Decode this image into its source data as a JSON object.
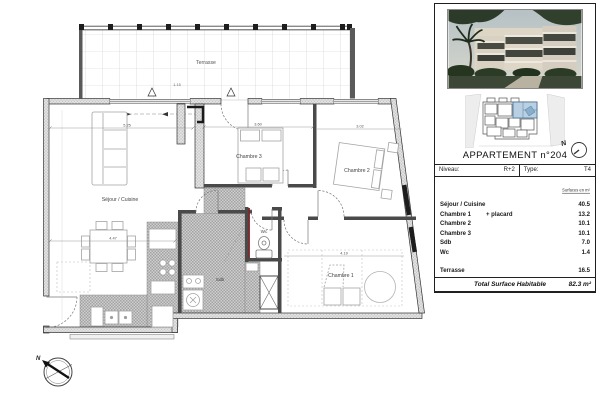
{
  "plan": {
    "rooms": {
      "terrasse": "Terrasse",
      "sejour": "Séjour / Cuisine",
      "chambre3": "Chambre 3",
      "chambre2": "Chambre 2",
      "chambre1": "Chambre 1",
      "sdb": "Sdb",
      "wc": "Wc"
    },
    "dimensions": {
      "sejour_width": "5.25",
      "chambre3_width": "3.60",
      "chambre2_width": "3.02",
      "sejour_depth": "4.47",
      "chambre1_width": "4.19",
      "terrasse_depth": "1.15"
    },
    "north_label": "N"
  },
  "panel": {
    "title": "APPARTEMENT n°204",
    "info": {
      "niveau_label": "Niveau:",
      "niveau_value": "R+2",
      "type_label": "Type:",
      "type_value": "T4"
    },
    "surfaces_note": "Surfaces en m²",
    "rooms": [
      {
        "name": "Séjour / Cuisine",
        "note": "",
        "area": "40.5"
      },
      {
        "name": "Chambre 1",
        "note": "+ placard",
        "area": "13.2"
      },
      {
        "name": "Chambre 2",
        "note": "",
        "area": "10.1"
      },
      {
        "name": "Chambre 3",
        "note": "",
        "area": "10.1"
      },
      {
        "name": "Sdb",
        "note": "",
        "area": "7.0"
      },
      {
        "name": "Wc",
        "note": "",
        "area": "1.4"
      },
      {
        "name": "Terrasse",
        "note": "",
        "area": "16.5"
      }
    ],
    "total": {
      "label": "Total Surface Habitable",
      "value": "82.3",
      "unit": "m²"
    },
    "north_label": "N"
  }
}
